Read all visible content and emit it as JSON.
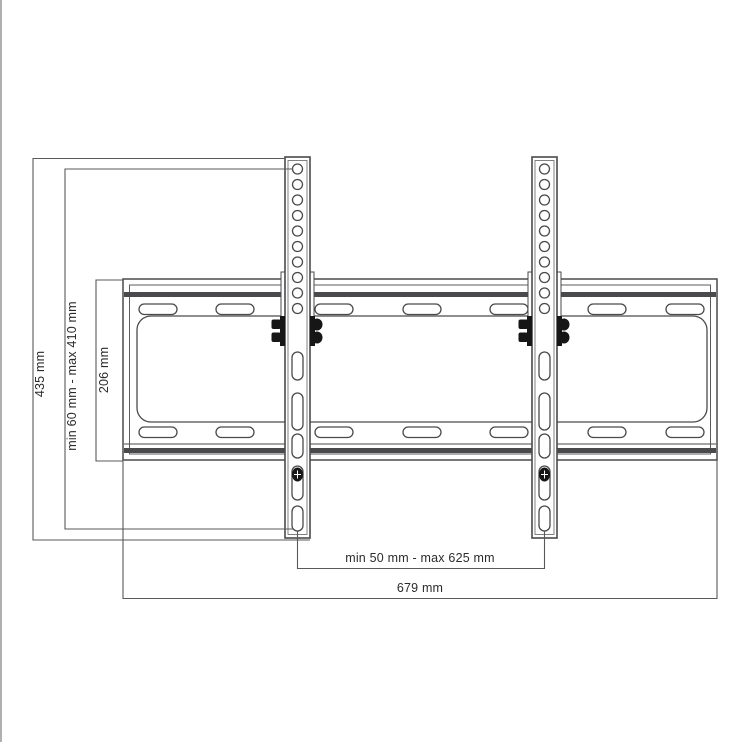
{
  "drawing": {
    "title": "tv-wall-mount-dimension-drawing",
    "dimensions": {
      "rail_height": "435 mm",
      "vertical_range": "min 60 mm - max 410 mm",
      "plate_height": "206 mm",
      "horizontal_range": "min 50 mm - max 625 mm",
      "plate_width": "679 mm"
    },
    "colors": {
      "outline": "#4a4a4c",
      "dimension_line": "#59595b",
      "hardware": "#161616",
      "text": "#2b2b2b",
      "background": "#ffffff",
      "edge_artifact": "#9d9da1"
    }
  }
}
